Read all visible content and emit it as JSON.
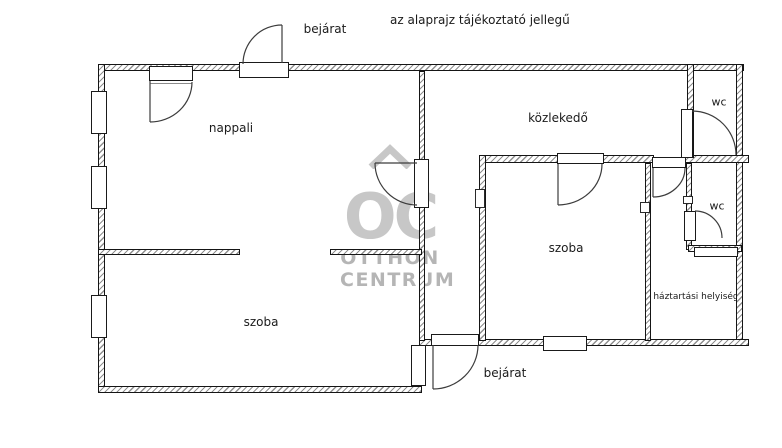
{
  "plan": {
    "disclaimer": "az alaprajz tájékoztató jellegű",
    "labels": [
      {
        "id": "bejarat-top",
        "text": "bejárat",
        "x": 325,
        "y": 29,
        "size": 12
      },
      {
        "id": "nappali",
        "text": "nappali",
        "x": 231,
        "y": 128,
        "size": 12
      },
      {
        "id": "kozlekedo",
        "text": "közlekedő",
        "x": 558,
        "y": 118,
        "size": 12
      },
      {
        "id": "wc-top",
        "text": "wc",
        "x": 719,
        "y": 102,
        "size": 11
      },
      {
        "id": "wc-middle",
        "text": "wc",
        "x": 717,
        "y": 206,
        "size": 11
      },
      {
        "id": "szoba-center",
        "text": "szoba",
        "x": 566,
        "y": 248,
        "size": 12
      },
      {
        "id": "haztartasi-helyiseg",
        "text": "háztartási helyiség",
        "x": 696,
        "y": 297,
        "size": 9
      },
      {
        "id": "szoba-left",
        "text": "szoba",
        "x": 261,
        "y": 322,
        "size": 12
      },
      {
        "id": "bejarat-bottom",
        "text": "bejárat",
        "x": 505,
        "y": 373,
        "size": 12
      }
    ],
    "watermark": {
      "initials": "OC",
      "line1": "OTTHON",
      "line2": "CENTRUM",
      "initials_color": "#c7c7c7",
      "text_color": "#b5b5b5"
    },
    "colors": {
      "wall_line": "#151515",
      "hatch": "#8f8f8f",
      "label_text": "#1b1b1b"
    }
  }
}
